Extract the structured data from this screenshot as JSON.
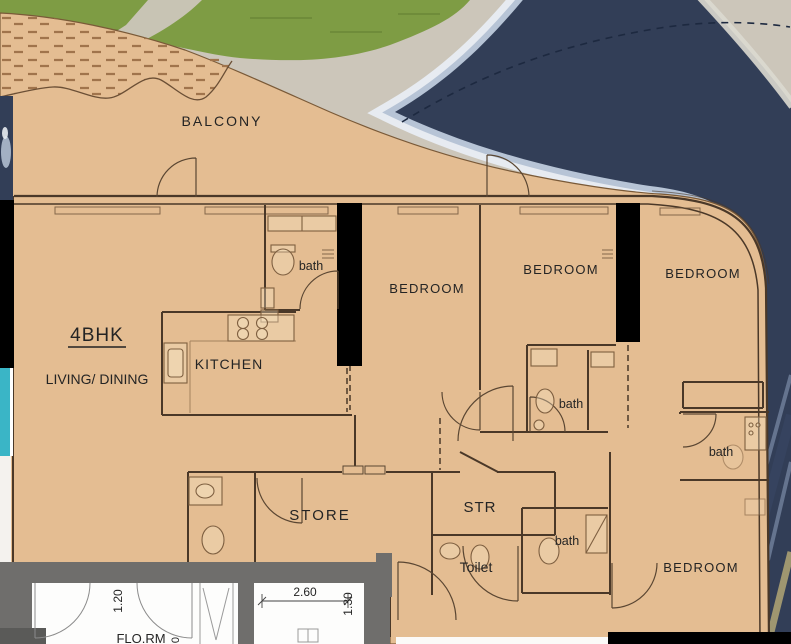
{
  "scene": {
    "unit_label": "4BHK",
    "rooms": {
      "balcony": "BALCONY",
      "living_dining": "LIVING/ DINING",
      "kitchen": "KITCHEN",
      "bedroom_top_center": "BEDROOM",
      "bedroom_top_mid": "BEDROOM",
      "bedroom_top_right": "BEDROOM",
      "bedroom_bottom_right": "BEDROOM",
      "bath_entry": "bath",
      "bath_middle": "bath",
      "bath_right": "bath",
      "bath_bottom": "bath",
      "store": "STORE",
      "str": "STR",
      "toilet": "Toilet"
    },
    "adjacent_unit": {
      "room_label": "FLO.RM",
      "dim_width": "2.60",
      "dim_depth": "1.30",
      "dim_left": "1.20",
      "dim_partial": "0"
    },
    "colors": {
      "floor": "#e4bd92",
      "water": "#323e57",
      "water_rim": "#b7c4d6",
      "water_halo": "#e7ebf1",
      "grass": "#7e9c44",
      "walkway": "#ccc6ba",
      "glass_teal": "#3ab5c6",
      "wall_dark": "#4a3828",
      "column": "#000000",
      "lower_wall_gray": "#6f6e6c",
      "hatch": "#a0744c"
    }
  }
}
